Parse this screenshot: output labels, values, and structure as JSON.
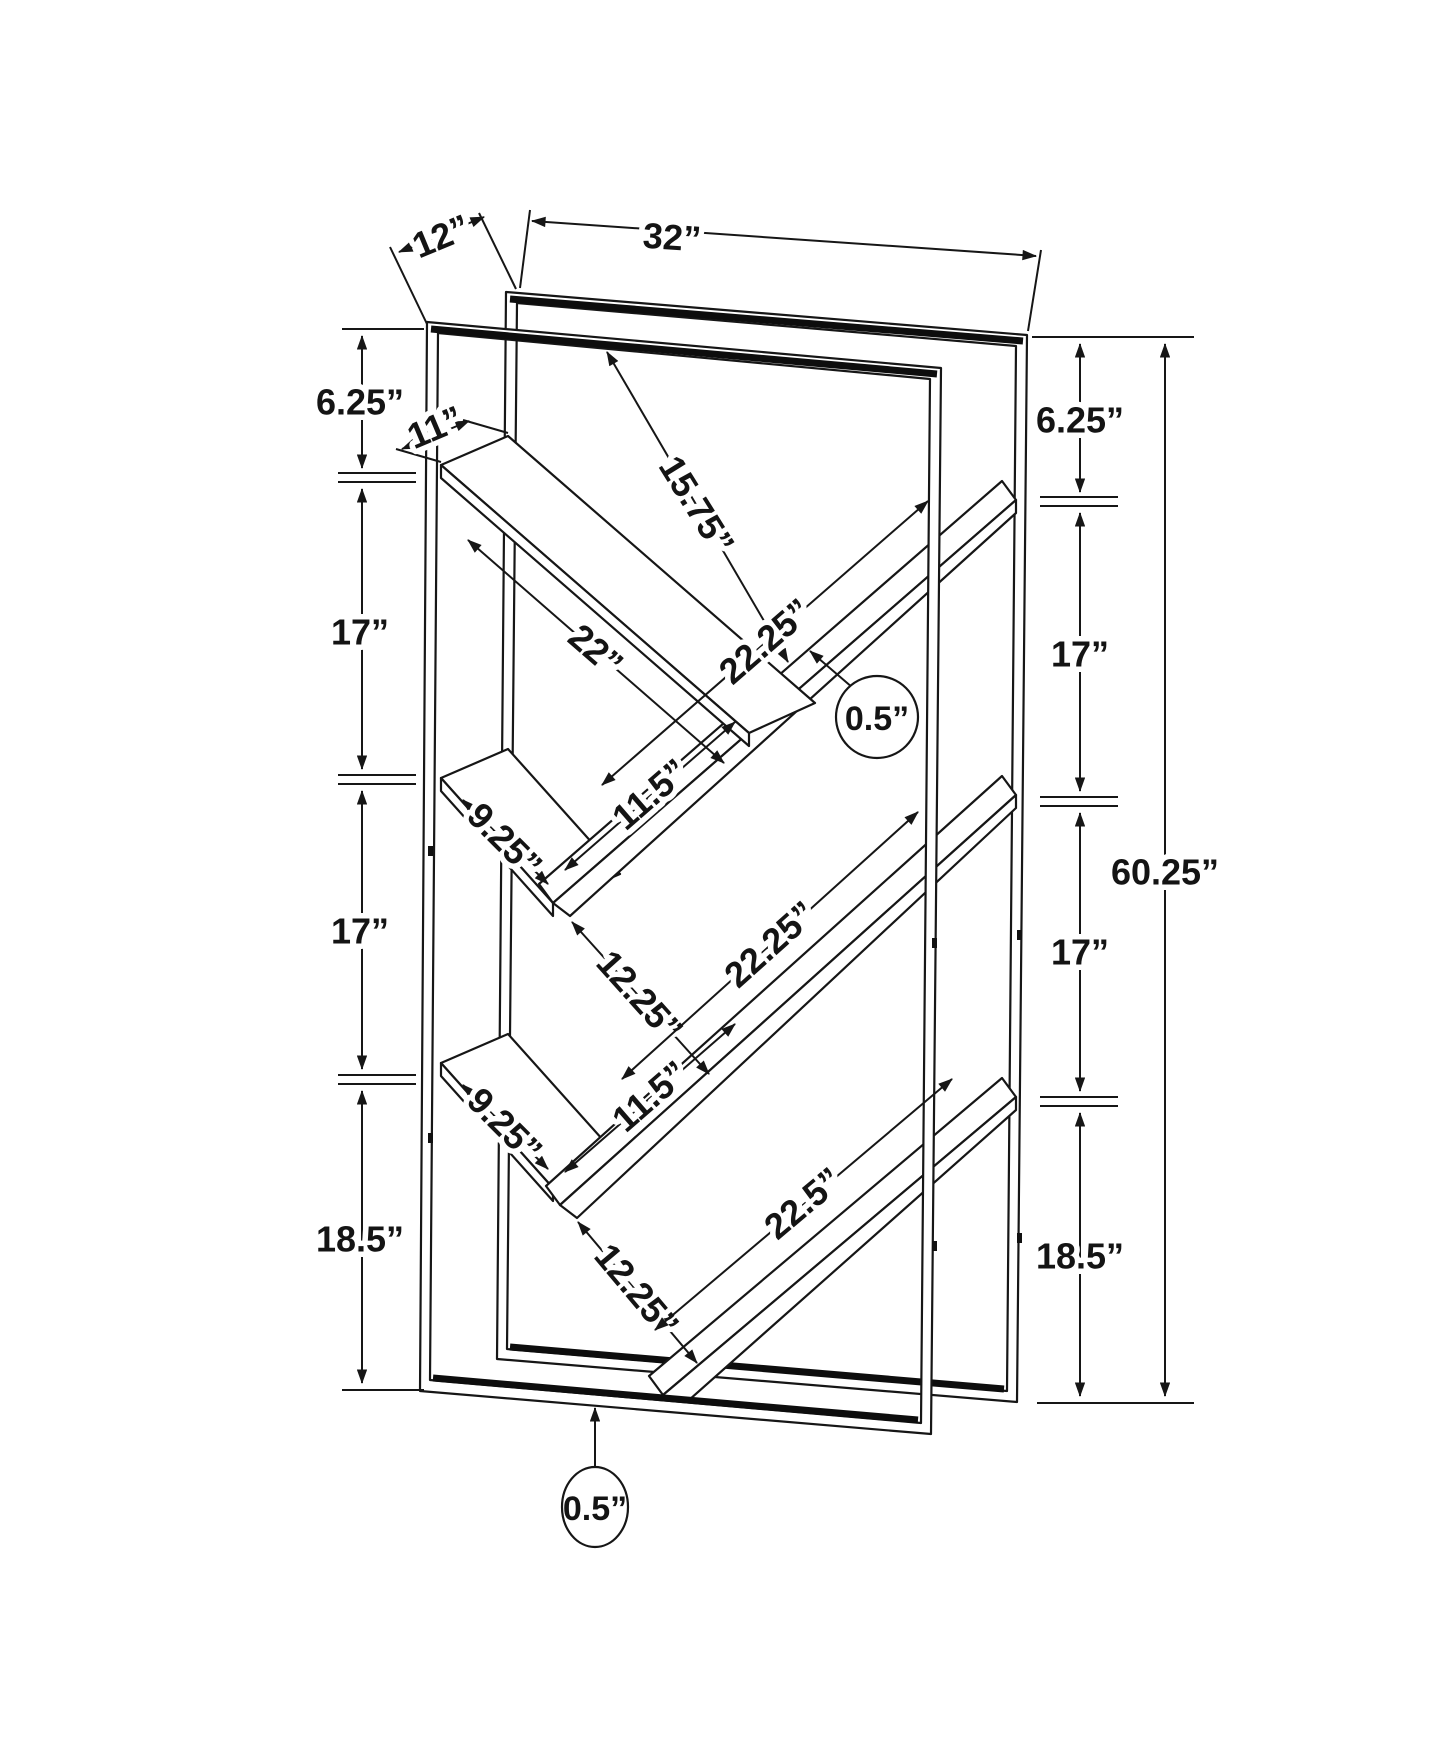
{
  "drawing": {
    "overall": {
      "width": "32”",
      "depth": "12”",
      "height": "60.25”"
    },
    "left_side": {
      "top": "6.25”",
      "upper_mid": "17”",
      "lower_mid": "17”",
      "bottom": "18.5”"
    },
    "right_side": {
      "top": "6.25”",
      "upper_mid": "17”",
      "lower_mid": "17”",
      "bottom": "18.5”"
    },
    "shelves": {
      "top_shelf_depth": "11”",
      "top_clearance": "15.75”",
      "upper_left_shelf_length": "22”",
      "upper_right_shelf_length": "22.25”",
      "upper_overhang": "11.5”",
      "upper_small_shelf": "9.25”",
      "upper_gap": "12.25”",
      "middle_right_shelf_length": "22.25”",
      "lower_small_shelf": "9.25”",
      "lower_overhang": "11.5”",
      "lower_gap": "12.25”",
      "bottom_shelf_length": "22.5”"
    },
    "thickness": {
      "shelf": "0.5”",
      "frame": "0.5”"
    }
  }
}
